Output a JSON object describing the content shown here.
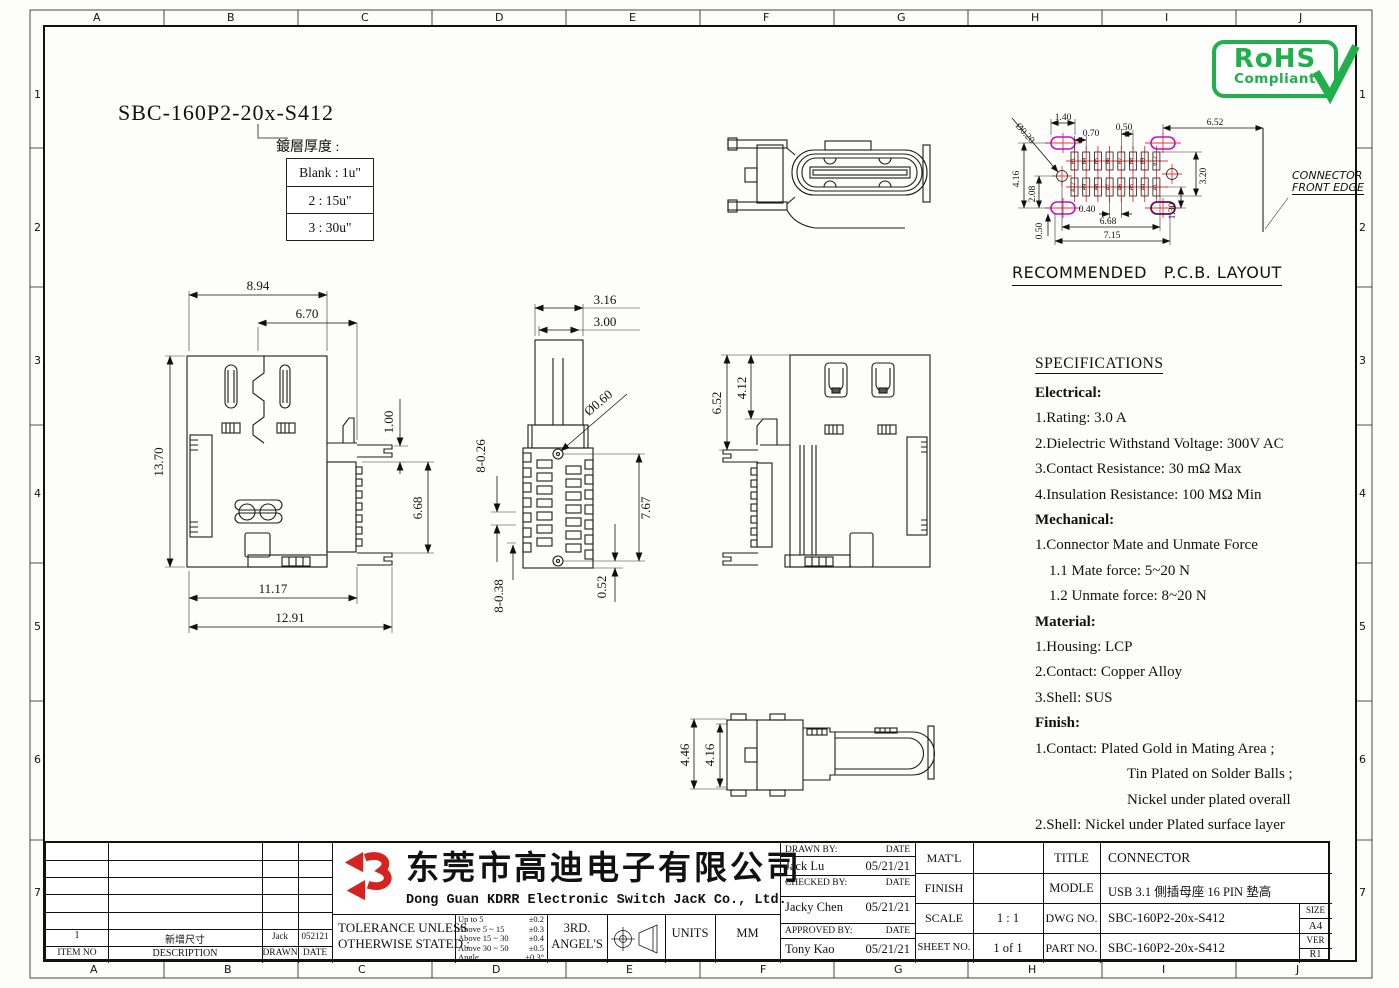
{
  "colors": {
    "line": "#1b1b1b",
    "rohs_green": "#1faf4b",
    "logo_red": "#d6231f",
    "pad_magenta": "#c410c4",
    "cross_red": "#ee3333"
  },
  "zones": {
    "cols": [
      "A",
      "B",
      "C",
      "D",
      "E",
      "F",
      "G",
      "H",
      "I",
      "J"
    ],
    "rows": [
      "1",
      "2",
      "3",
      "4",
      "5",
      "6",
      "7"
    ]
  },
  "header": {
    "part_code": "SBC-160P2-20x-S412",
    "plating_label": "鍍層厚度 :",
    "plating_options": [
      "Blank : 1u\"",
      "2 : 15u\"",
      "3 : 30u\""
    ],
    "rohs": {
      "title": "RoHS",
      "subtitle": "Compliant"
    }
  },
  "views": {
    "front_view": {
      "dim_width_top": "8.94",
      "dim_width_inner": "6.70",
      "dim_height": "13.70",
      "dim_step": "1.00",
      "dim_tail_height": "6.68",
      "dim_width_body": "11.17",
      "dim_width_overall": "12.91"
    },
    "bottom_view": {
      "dim_tongue_outer": "3.16",
      "dim_tongue_inner": "3.00",
      "dim_ball": "Ø0.60",
      "dim_pitch_a": "8-0.26",
      "dim_pitch_b": "8-0.38",
      "dim_depth": "7.67",
      "dim_offset": "0.52"
    },
    "side_view": {
      "dim_height_a": "6.52",
      "dim_height_b": "4.12"
    },
    "profile_view": {
      "dim_height_a": "4.46",
      "dim_height_b": "4.16"
    }
  },
  "pcb_layout": {
    "title": "RECOMMENDED   P.C.B. LAYOUT",
    "front_edge_label_1": "CONNECTOR",
    "front_edge_label_2": "FRONT EDGE",
    "pads_top": [
      "B1",
      "B4",
      "B5",
      "B6",
      "B7",
      "B8",
      "B9",
      "B12"
    ],
    "pads_bottom": [
      "A12",
      "A9",
      "A8",
      "A7",
      "A6",
      "A5",
      "A4",
      "A1"
    ],
    "dims": {
      "hole_width": "1.40",
      "pad_pitch": "0.70",
      "pad_gap": "0.50",
      "edge_offset": "6.52",
      "via": "Ø0.20",
      "hole_pitch_y": "4.16",
      "center_offset": "2.08",
      "pad_span": "3.20",
      "row_offset": "1.30",
      "slot": "0.40",
      "pad_row_width": "6.68",
      "hole_span": "7.15",
      "corner": "0.50"
    }
  },
  "specifications": {
    "title": "SPECIFICATIONS",
    "lines": [
      "Electrical:",
      "1.Rating: 3.0 A",
      "2.Dielectric Withstand Voltage: 300V AC",
      "3.Contact Resistance: 30 mΩ Max",
      "4.Insulation Resistance: 100 MΩ Min",
      "Mechanical:",
      "1.Connector Mate and Unmate Force",
      "1.1 Mate force: 5~20 N",
      "1.2 Unmate force: 8~20 N",
      "Material:",
      "1.Housing: LCP",
      "2.Contact: Copper Alloy",
      "3.Shell: SUS",
      "Finish:",
      "1.Contact: Plated Gold in Mating Area ;",
      "Tin Plated on Solder Balls ;",
      "Nickel under plated overall",
      "2.Shell: Nickel under Plated surface layer"
    ]
  },
  "revision_table": {
    "headers": {
      "item": "ITEM NO",
      "description": "DESCRIPTION",
      "drawn": "DRAWN",
      "date": "DATE"
    },
    "rows": [
      {
        "item": "1",
        "description": "新增尺寸",
        "drawn": "Jack",
        "date": "052121"
      }
    ]
  },
  "company": {
    "name_cn": "东莞市高迪电子有限公司",
    "name_en": "Dong Guan KDRR  Electronic Switch JacK Co., Ltd."
  },
  "tolerance_block": {
    "label_line1": "TOLERANCE UNLESS",
    "label_line2": "OTHERWISE STATED :",
    "rows": [
      {
        "range": "Up  to 5",
        "tol": "±0.2"
      },
      {
        "range": "Above 5  ~ 15",
        "tol": "±0.3"
      },
      {
        "range": "Above 15 ~ 30",
        "tol": "±0.4"
      },
      {
        "range": "Above 30 ~ 50",
        "tol": "±0.5"
      },
      {
        "range": "Angle",
        "tol": "±0.3°"
      }
    ],
    "projection_line1": "3RD.",
    "projection_line2": "ANGEL'S",
    "units_label": "UNITS",
    "units_value": "MM"
  },
  "title_block": {
    "drawn_by_label": "DRAWN BY:",
    "date_label": "DATE",
    "drawn_by": "Jack  Lu",
    "drawn_date": "05/21/21",
    "checked_by_label": "CHECKED BY:",
    "checked_by": "Jacky Chen",
    "checked_date": "05/21/21",
    "approved_by_label": "APPROVED BY:",
    "approved_by": "Tony Kao",
    "approved_date": "05/21/21",
    "matl_label": "MAT'L",
    "finish_label": "FINISH",
    "scale_label": "SCALE",
    "scale_value": "1 : 1",
    "sheet_label": "SHEET NO.",
    "sheet_value": "1 of 1",
    "title_label": "TITLE",
    "title_value": "CONNECTOR",
    "modle_label": "MODLE",
    "modle_value": "USB 3.1  側插母座 16 PIN 墊高",
    "dwg_label": "DWG NO.",
    "dwg_value": "SBC-160P2-20x-S412",
    "part_label": "PART NO.",
    "part_value": "SBC-160P2-20x-S412",
    "size_label": "SIZE",
    "size_value": "A4",
    "ver_label": "VER",
    "ver_value": "R1"
  }
}
